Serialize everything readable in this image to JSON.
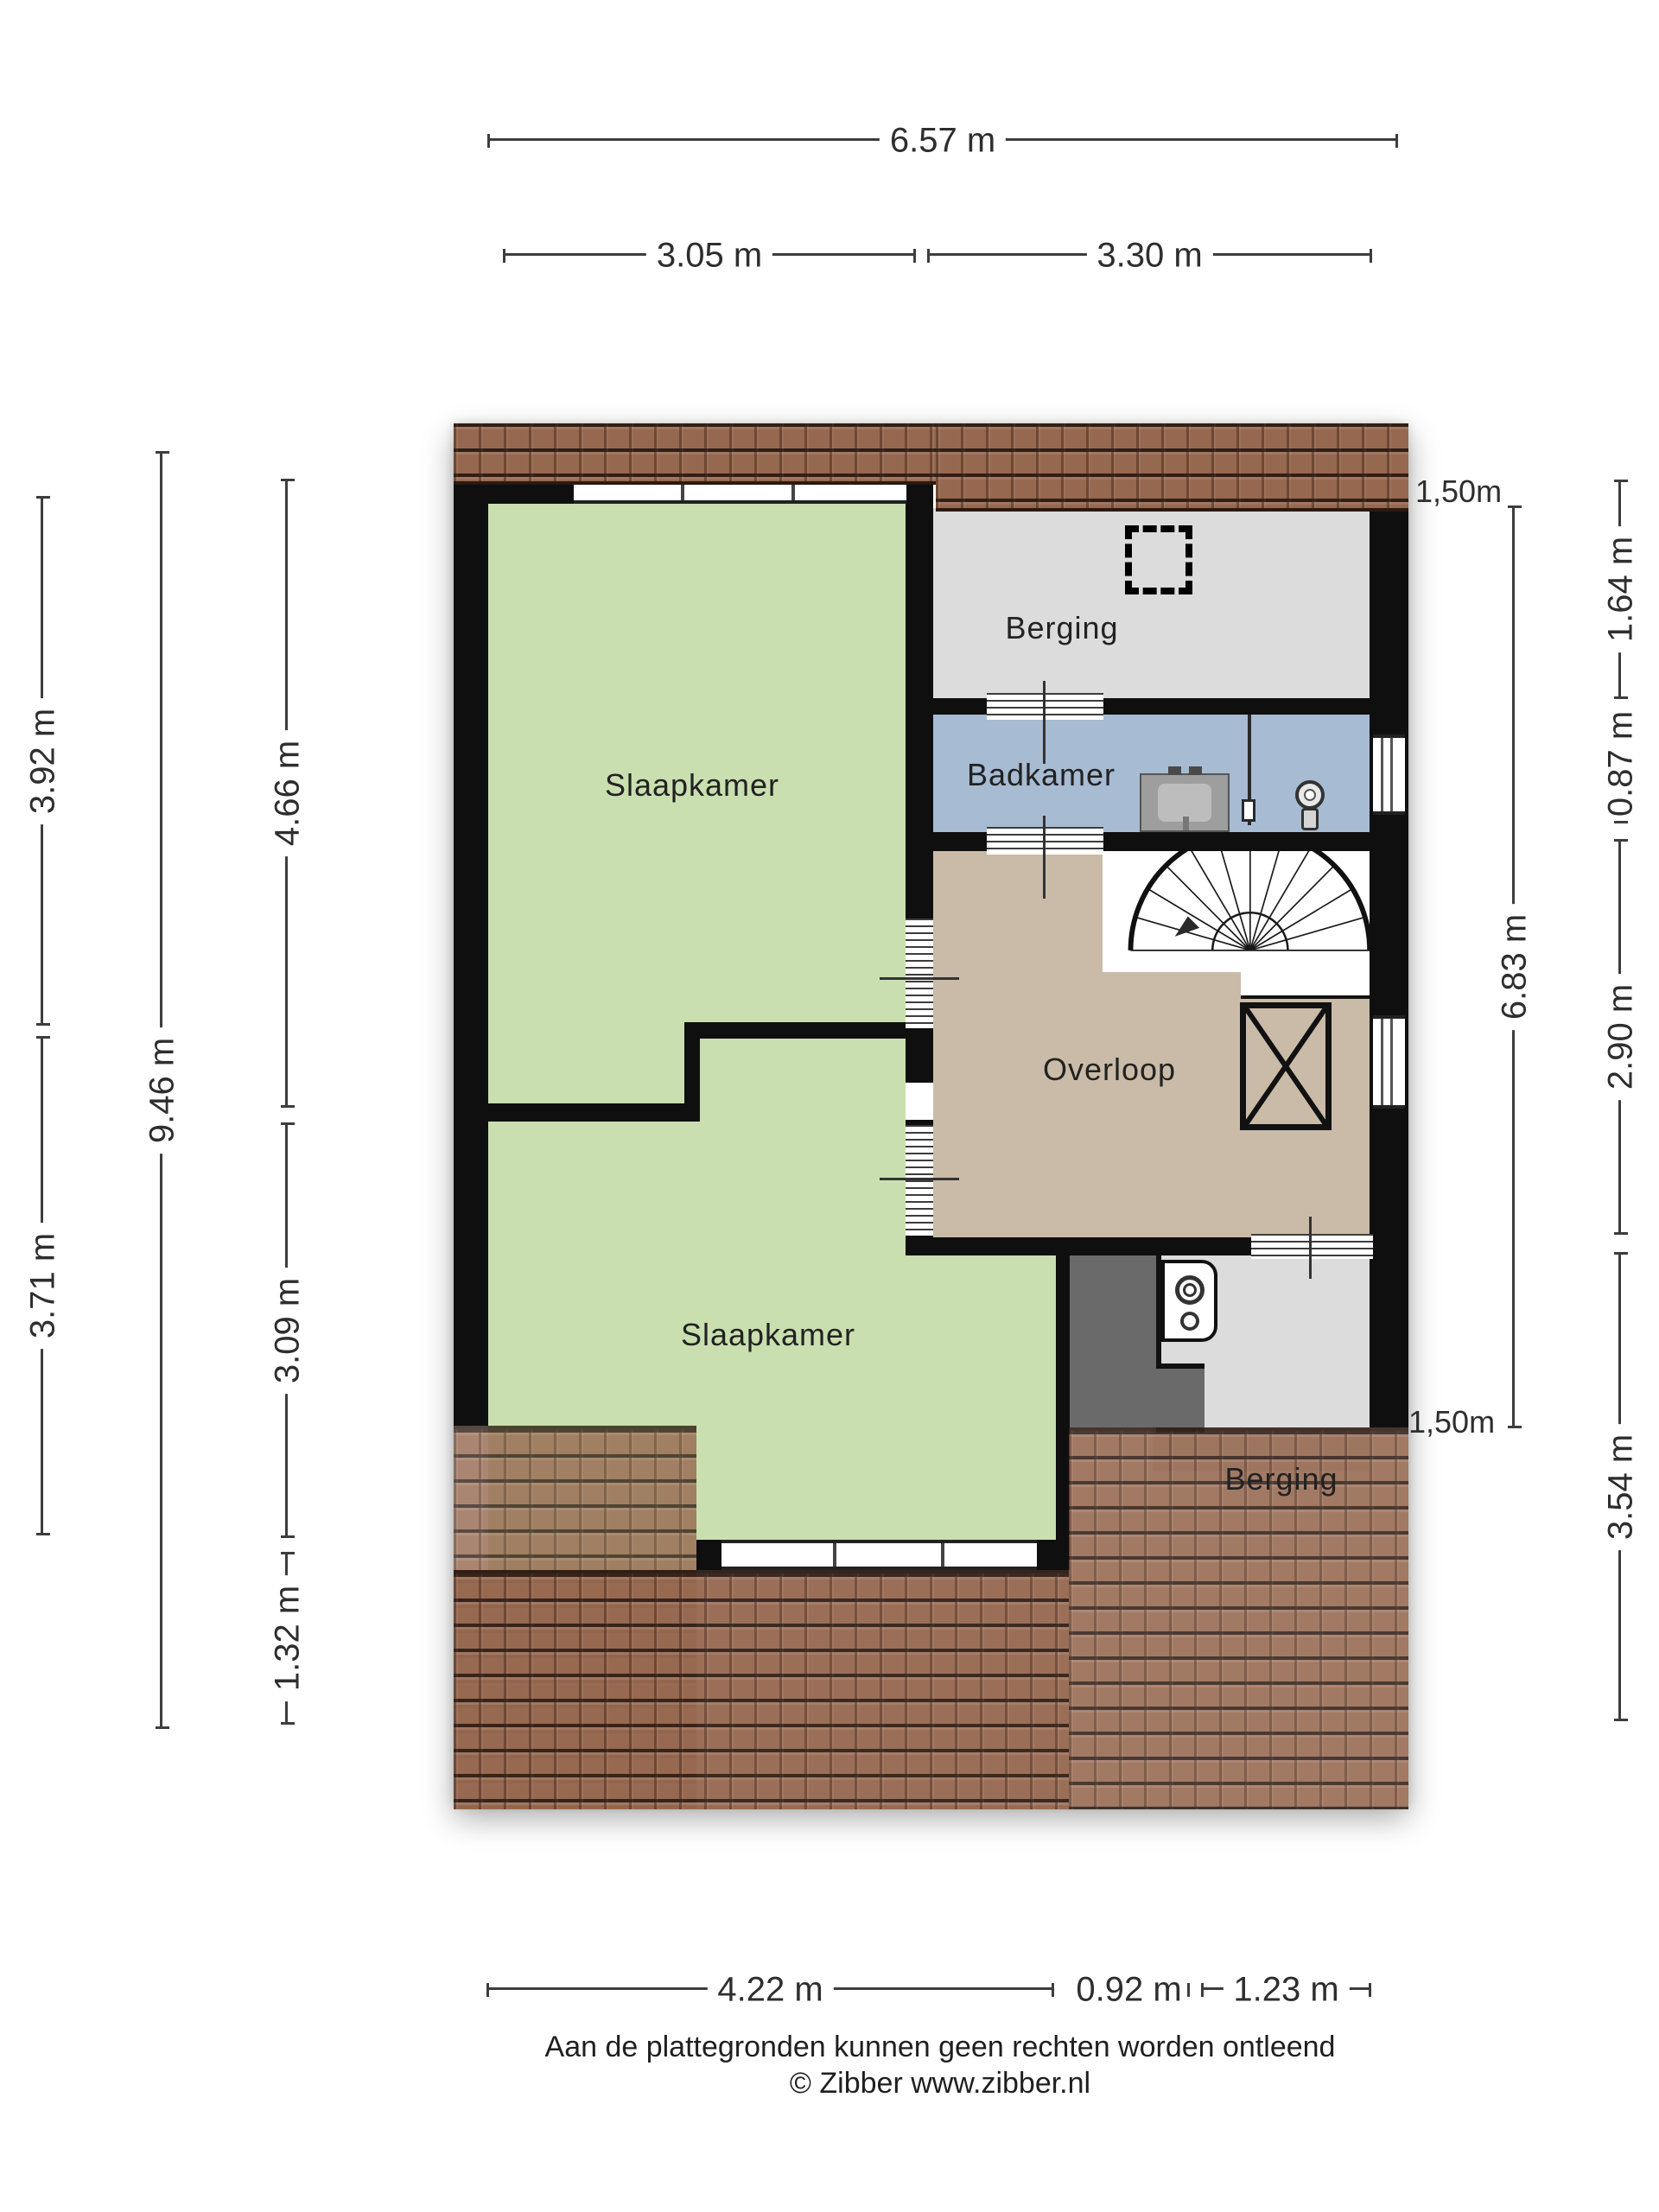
{
  "meta": {
    "type": "floorplan",
    "language": "nl"
  },
  "rooms": {
    "bedroom_top": "Slaapkamer",
    "storage_top": "Berging",
    "bathroom": "Badkamer",
    "landing": "Overloop",
    "bedroom_bottom": "Slaapkamer",
    "storage_bottom": "Berging"
  },
  "annotations": {
    "knee_wall_top": "1,50m",
    "knee_wall_bottom": "1,50m"
  },
  "dimensions": {
    "overall_width": "6.57 m",
    "top_left_width": "3.05 m",
    "top_right_width": "3.30 m",
    "left_outer_upper": "3.92 m",
    "left_outer_lower": "3.71 m",
    "left_total_height": "9.46 m",
    "left_inner_upper": "4.66 m",
    "left_inner_lower": "3.09 m",
    "left_inner_bottom": "1.32 m",
    "right_inner_height": "6.83 m",
    "right_outer_1": "1.64 m",
    "right_outer_2": "0.87 m",
    "right_outer_3": "2.90 m",
    "right_outer_4": "3.54 m",
    "bottom_left_width": "4.22 m",
    "bottom_mid_width": "0.92 m",
    "bottom_right_width": "1.23 m"
  },
  "footer": {
    "disclaimer": "Aan de plattegronden kunnen geen rechten worden ontleend",
    "credit": "© Zibber www.zibber.nl"
  },
  "colors": {
    "bedroom_green": "#cadfaf",
    "storage_grey": "#dcdcdc",
    "bathroom_blue": "#a7bbd3",
    "landing_tan": "#c9bba7",
    "duct_grey": "#6a6a6a",
    "roof_brown": "#96684f",
    "wall_black": "#0f0f0f",
    "dimension_grey": "#3d3d3d"
  }
}
